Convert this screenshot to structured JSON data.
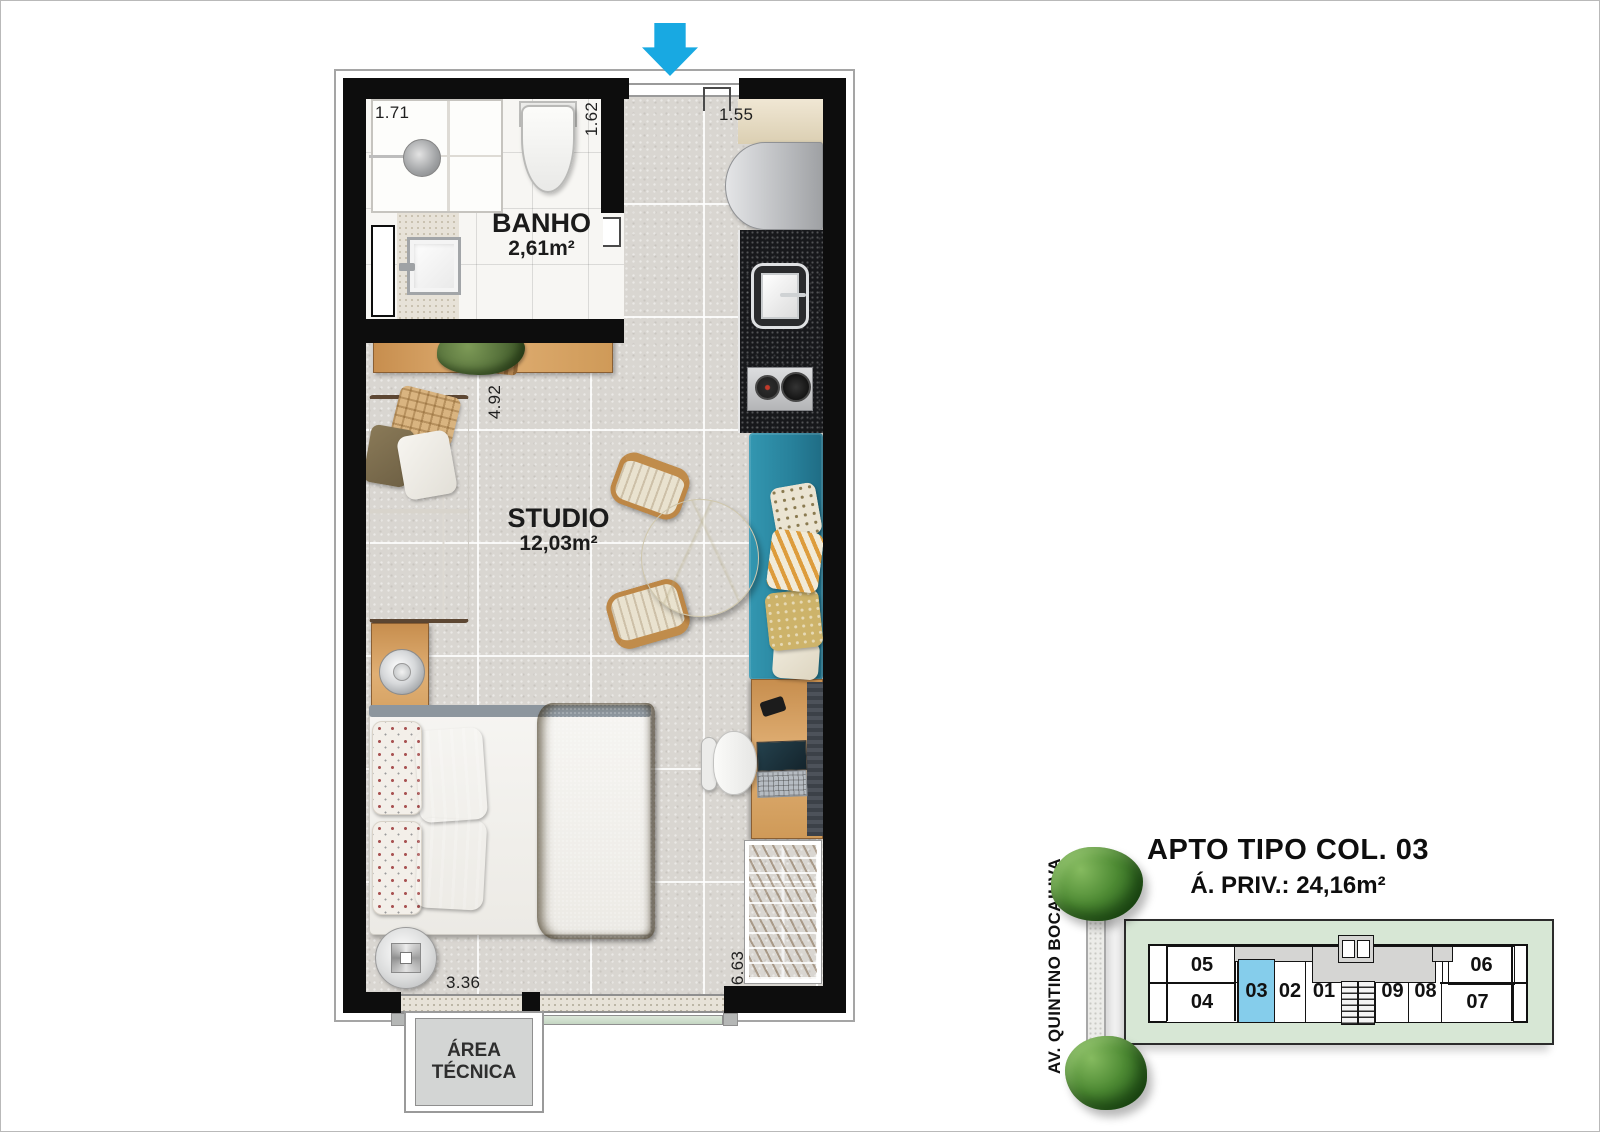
{
  "plan": {
    "banho": {
      "name": "BANHO",
      "area": "2,61m²"
    },
    "studio": {
      "name": "STUDIO",
      "area": "12,03m²"
    },
    "area_tecnica": {
      "line1": "ÁREA",
      "line2": "TÉCNICA"
    },
    "dims": {
      "shower_width": "1.71",
      "banho_depth": "1.62",
      "entry_width": "1.55",
      "studio_length": "4.92",
      "studio_width": "3.36",
      "side_length": "6.63"
    }
  },
  "legend": {
    "title": "APTO TIPO COL. 03",
    "subtitle": "Á. PRIV.: 24,16m²"
  },
  "street_label": "AV. QUINTINO BOCAIUVA",
  "key_plan": {
    "highlighted_unit": "03",
    "units": {
      "u05": "05",
      "u04": "04",
      "u03": "03",
      "u02": "02",
      "u01": "01",
      "u09": "09",
      "u08": "08",
      "u07": "07",
      "u06": "06"
    }
  },
  "colors": {
    "arrow_blue": "#18a9e2",
    "highlight_blue": "#85cdeb",
    "site_green": "#d7e7d5",
    "bench_teal": "#2d8aa4",
    "wood": "#d09a5b",
    "wall_black": "#0d0d0d"
  }
}
